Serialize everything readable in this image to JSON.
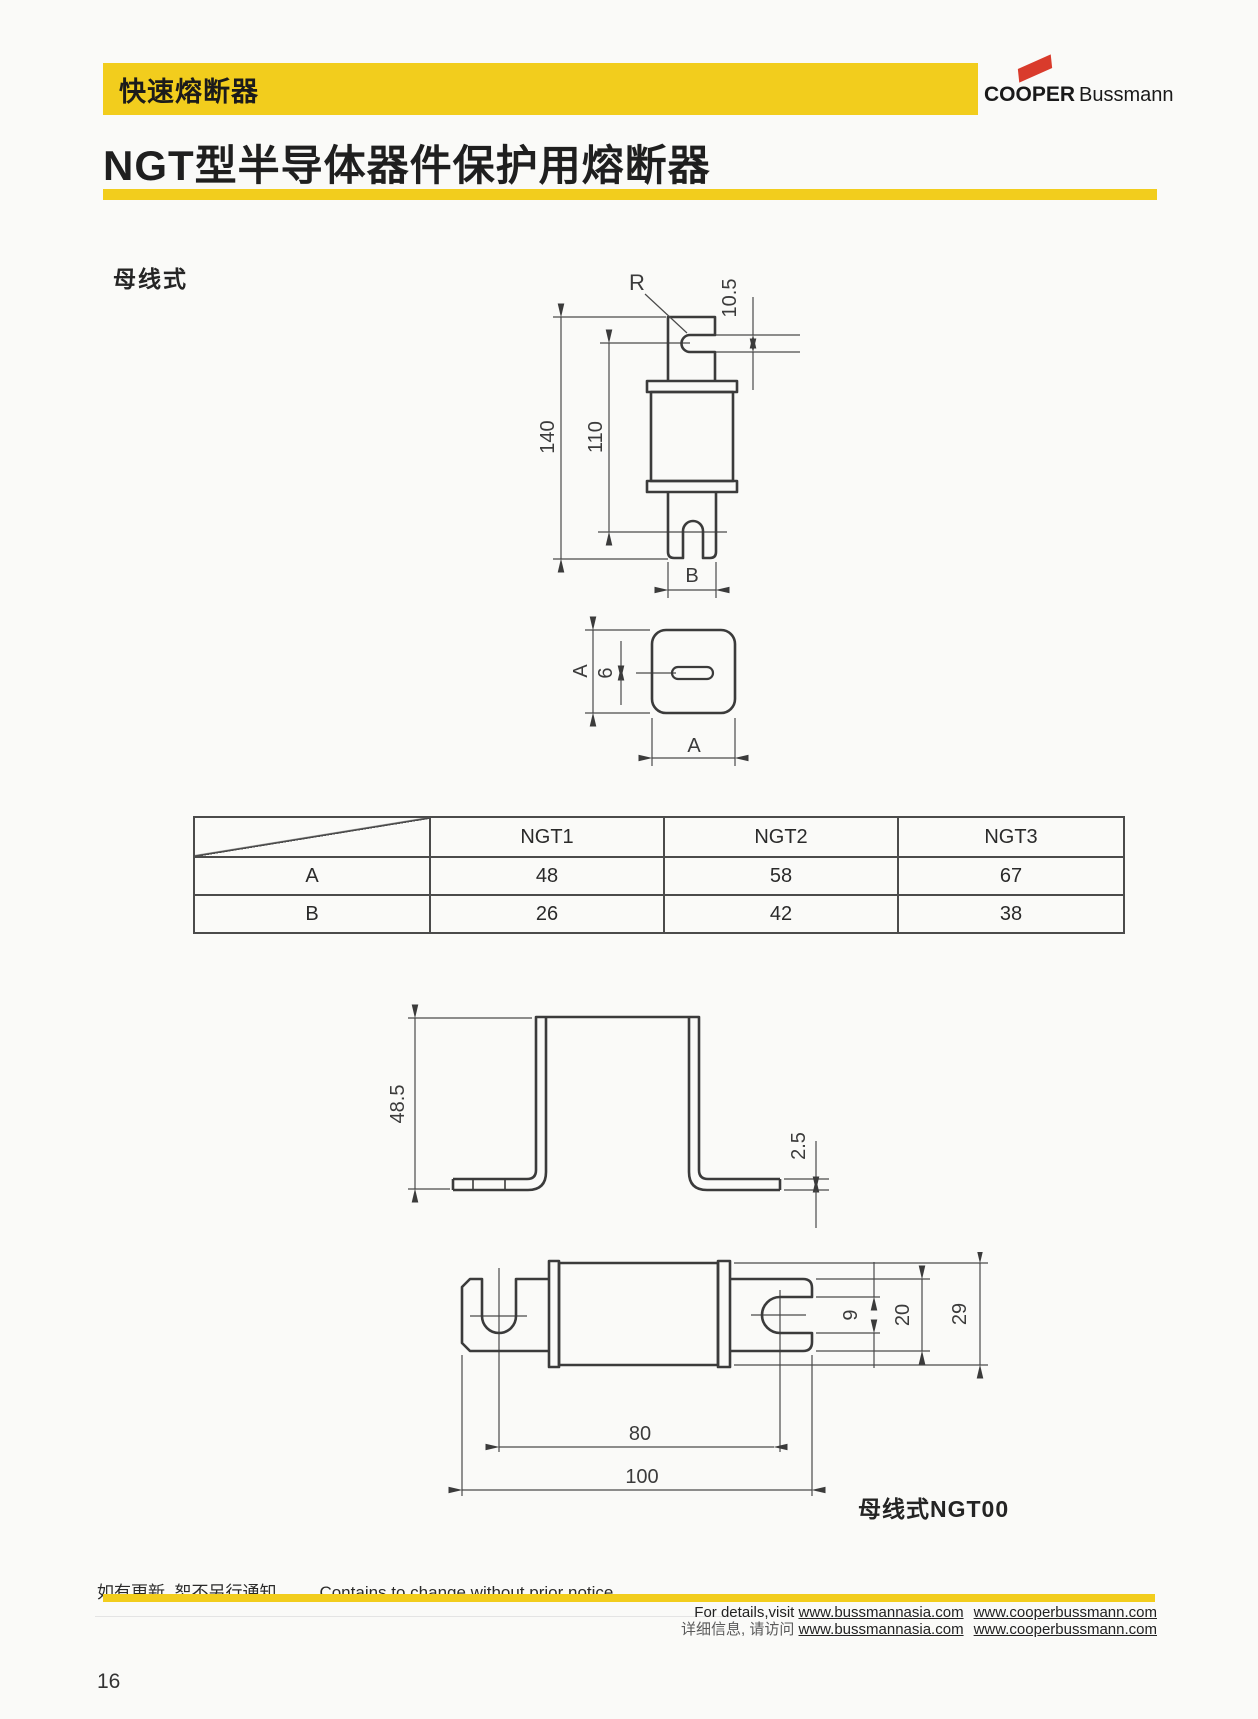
{
  "colors": {
    "accent": "#f2cd1d",
    "logo_red": "#d93b2c"
  },
  "header": {
    "category": "快速熔断器",
    "title": "NGT型半导体器件保护用熔断器"
  },
  "logo": {
    "part1": "COOPER",
    "part2": "Bussmann"
  },
  "section_label": "母线式",
  "d1": {
    "r": "R",
    "slot": "10.5",
    "overall": "140",
    "body": "110",
    "blade": "B"
  },
  "d2": {
    "side": "A",
    "slot": "6",
    "bottom": "A"
  },
  "d3": {
    "height": "48.5",
    "thickness": "2.5"
  },
  "d4": {
    "slot": "9",
    "blade": "20",
    "body": "29",
    "span": "80",
    "length": "100",
    "caption": "母线式NGT00"
  },
  "table": {
    "cols": [
      "NGT1",
      "NGT2",
      "NGT3"
    ],
    "rows": [
      {
        "label": "A",
        "values": [
          "48",
          "58",
          "67"
        ]
      },
      {
        "label": "B",
        "values": [
          "26",
          "42",
          "38"
        ]
      }
    ]
  },
  "footer": {
    "notice_cn": "如有更新, 恕不另行通知。",
    "notice_en": "Contains to change without prior notice.",
    "details_prefix_en": "For details,visit",
    "details_prefix_cn": "详细信息, 请访问",
    "url1": "www.bussmannasia.com",
    "url2": "www.cooperbussmann.com"
  },
  "page_number": "16"
}
